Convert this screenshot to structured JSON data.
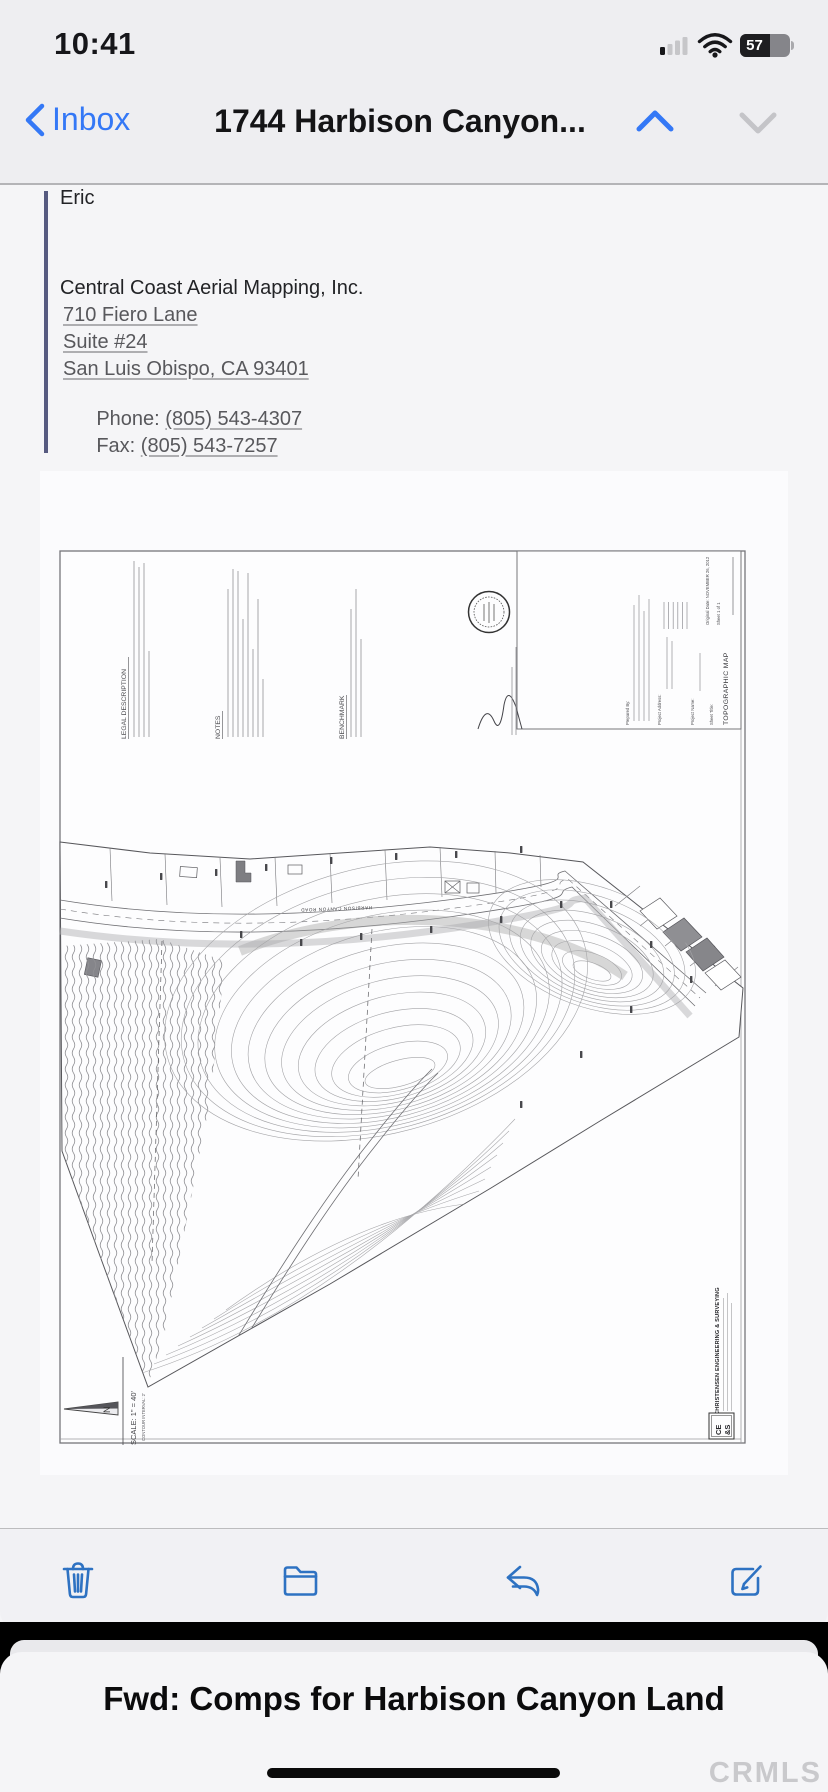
{
  "status_bar": {
    "time": "10:41",
    "battery_percent": "57"
  },
  "nav_bar": {
    "back_label": "Inbox",
    "title": "1744 Harbison Canyon..."
  },
  "email": {
    "greeting": "Eric",
    "company": "Central Coast Aerial Mapping, Inc.",
    "address_line1": "710 Fiero Lane",
    "address_line2": "Suite #24",
    "address_line3": "San Luis Obispo, CA 93401",
    "phone_label": "Phone: ",
    "phone_number": "(805) 543-4307",
    "fax_label": "Fax: ",
    "fax_number": "(805) 543-7257"
  },
  "map": {
    "legal_description_header": "LEGAL DESCRIPTION",
    "notes_header": "NOTES",
    "benchmark_header": "BENCHMARK",
    "road_label": "HARBISON CANYON ROAD",
    "title_block": {
      "prepared_by_label": "Prepared By:",
      "project_address_label": "Project Address:",
      "project_name_label": "Project Name:",
      "sheet_title_label": "Sheet Title:",
      "sheet_title": "TOPOGRAPHIC MAP",
      "original_date": "Original Date: NOVEMBER 26, 2012",
      "sheet_number": "Sheet 1 of 1"
    },
    "north_label": "N",
    "scale_text": "SCALE: 1\" = 40'",
    "contour_interval_text": "CONTOUR INTERVAL: 2'",
    "stamp_company": "CHRISTENSEN ENGINEERING & SURVEYING",
    "stamp_logo_top": "CE",
    "stamp_logo_bottom": "&S"
  },
  "bottom_sheet": {
    "title": "Fwd: Comps for Harbison Canyon Land"
  },
  "watermark": "CRMLS",
  "colors": {
    "ios_blue": "#3478f6",
    "toolbar_icon_blue": "#2e72c2",
    "link_gray": "#58585c"
  }
}
